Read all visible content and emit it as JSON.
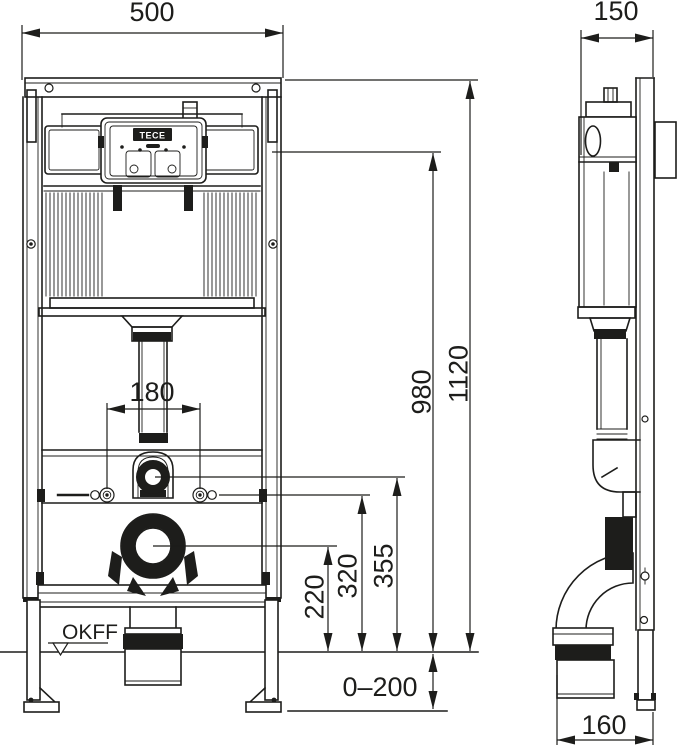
{
  "drawing": {
    "type": "technical-installation-drawing",
    "views": {
      "front": "front elevation of WC pre-wall module",
      "side": "side elevation of WC pre-wall module"
    },
    "brand": "TECE",
    "floor_level_label": "OKFF",
    "dim": {
      "front_width": "500",
      "side_depth": "150",
      "total_height": "1120",
      "flush_unit_height": "980",
      "flush_bend_height": "355",
      "fixing_height": "320",
      "outlet_height": "220",
      "fixing_spacing": "180",
      "leg_adjustment": "0–200",
      "outlet_offset": "160"
    },
    "colors": {
      "line": "#1d1d1b",
      "background": "#ffffff"
    }
  }
}
